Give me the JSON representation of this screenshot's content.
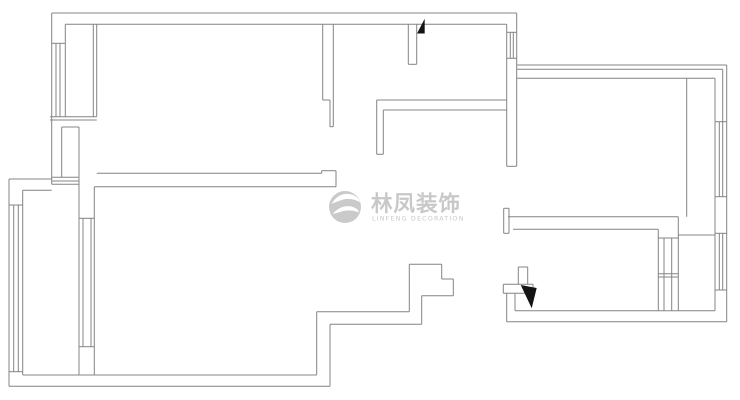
{
  "watermark": {
    "brand_cn": "林凤装饰",
    "brand_en": "LINFENG DECORATION",
    "color": "#c4c4c4",
    "logo_color": "#c6c6c6"
  },
  "floor_plan": {
    "background": "#ffffff",
    "stroke": "#848484",
    "marker_color": "#141414",
    "walls": [
      [
        52,
        13,
        516.7,
        13
      ],
      [
        516.7,
        13,
        516.7,
        166.3
      ],
      [
        516.7,
        65,
        726.7,
        65
      ],
      [
        726.7,
        65,
        726.7,
        321.7
      ],
      [
        506.7,
        321.7,
        726.7,
        321.7
      ],
      [
        506.7,
        293.3,
        506.7,
        321.7
      ],
      [
        503.3,
        284.3,
        533,
        284.3
      ],
      [
        503.3,
        293.3,
        533,
        293.3
      ],
      [
        503.3,
        284.3,
        503.3,
        293.3
      ],
      [
        533,
        284.3,
        533,
        293.3
      ],
      [
        518.3,
        267,
        518.3,
        284.3
      ],
      [
        527.7,
        267,
        527.7,
        284.3
      ],
      [
        518.3,
        267,
        527.7,
        267
      ],
      [
        515,
        293.3,
        515,
        310.7
      ],
      [
        409.3,
        264.3,
        441.7,
        264.3
      ],
      [
        441.7,
        264.3,
        441.7,
        279
      ],
      [
        441.7,
        279,
        453.3,
        279
      ],
      [
        453.3,
        279,
        453.3,
        295.7
      ],
      [
        421.7,
        295.7,
        453.3,
        295.7
      ],
      [
        421.7,
        295.7,
        421.7,
        324.3
      ],
      [
        330,
        324.3,
        421.7,
        324.3
      ],
      [
        330,
        324.3,
        330,
        386.3
      ],
      [
        9,
        386.3,
        330,
        386.3
      ],
      [
        22.7,
        375,
        316.7,
        375
      ],
      [
        409.3,
        264.3,
        409.3,
        311.7
      ],
      [
        316.7,
        311.7,
        409.3,
        311.7
      ],
      [
        316.7,
        311.7,
        316.7,
        375
      ],
      [
        9,
        179,
        9,
        386.3
      ],
      [
        9,
        179,
        51.7,
        179
      ],
      [
        22.7,
        190.3,
        51.7,
        190.3
      ],
      [
        22.7,
        190.3,
        22.7,
        375
      ],
      [
        51.7,
        13,
        51.7,
        184.3
      ],
      [
        65.3,
        24.3,
        65.3,
        43.3
      ],
      [
        65.3,
        24.3,
        506.7,
        24.3
      ],
      [
        93.3,
        24.3,
        93.3,
        116.7
      ],
      [
        96.7,
        24.3,
        96.7,
        116.7
      ],
      [
        50,
        116.7,
        96.7,
        116.7
      ],
      [
        50,
        120,
        96.7,
        120
      ],
      [
        61.7,
        127,
        61.7,
        177.3
      ],
      [
        79,
        127,
        79,
        177.3
      ],
      [
        61.7,
        127,
        79,
        127
      ],
      [
        51.7,
        177.3,
        79,
        177.3
      ],
      [
        51.7,
        181,
        79,
        181
      ],
      [
        51.7,
        184.3,
        79,
        184.3
      ],
      [
        79,
        177.3,
        79,
        375
      ],
      [
        94.3,
        186.7,
        94.3,
        375
      ],
      [
        96.7,
        173.3,
        321.7,
        173.3
      ],
      [
        94.3,
        186.7,
        336,
        186.7
      ],
      [
        321.7,
        170.7,
        321.7,
        173.3
      ],
      [
        321.7,
        170.7,
        336,
        170.7
      ],
      [
        336,
        170.7,
        336,
        186.7
      ],
      [
        322.7,
        24.3,
        322.7,
        100
      ],
      [
        322.7,
        100,
        330,
        100
      ],
      [
        330,
        100,
        330,
        126.7
      ],
      [
        330,
        126.7,
        333.3,
        126.7
      ],
      [
        333.3,
        24.3,
        333.3,
        126.7
      ],
      [
        408.3,
        24.3,
        408.3,
        64.3
      ],
      [
        416.7,
        24.3,
        416.7,
        64.3
      ],
      [
        408.3,
        64.3,
        416.7,
        64.3
      ],
      [
        376.7,
        100,
        506.7,
        100
      ],
      [
        383.3,
        110,
        506.7,
        110
      ],
      [
        376.7,
        100,
        376.7,
        154.3
      ],
      [
        383.3,
        110,
        383.3,
        154.3
      ],
      [
        376.7,
        154.3,
        383.3,
        154.3
      ],
      [
        506.7,
        24.3,
        506.7,
        166.3
      ],
      [
        506.7,
        166.3,
        516.7,
        166.3
      ],
      [
        516.7,
        69.3,
        722.7,
        69.3
      ],
      [
        722.7,
        69.3,
        722.7,
        121.7
      ],
      [
        516.7,
        78.3,
        715,
        78.3
      ],
      [
        686.7,
        78.3,
        686.7,
        216.7
      ],
      [
        715,
        78.3,
        715,
        121.7
      ],
      [
        715,
        196.7,
        715,
        233.3
      ],
      [
        715,
        290,
        715,
        310.7
      ],
      [
        508,
        216.7,
        678.3,
        216.7
      ],
      [
        513,
        229.3,
        658.3,
        229.3
      ],
      [
        503.7,
        208.3,
        509,
        208.3
      ],
      [
        503.7,
        233.3,
        509,
        233.3
      ],
      [
        503.7,
        208.3,
        503.7,
        233.3
      ],
      [
        509,
        208.3,
        509,
        233.3
      ],
      [
        678.3,
        216.7,
        678.3,
        235
      ],
      [
        678.3,
        235,
        715,
        235
      ],
      [
        658.3,
        229.3,
        658.3,
        310.7
      ],
      [
        678.3,
        235,
        678.3,
        310.7
      ],
      [
        515,
        310.7,
        715,
        310.7
      ]
    ],
    "window_lines": [
      [
        56,
        43.3,
        56,
        116.7
      ],
      [
        60,
        43.3,
        60,
        116.7
      ],
      [
        65.3,
        43.3,
        65.3,
        116.7
      ],
      [
        51.7,
        43.3,
        65.3,
        43.3
      ],
      [
        13.7,
        205,
        13.7,
        371.7
      ],
      [
        18.3,
        205,
        18.3,
        371.7
      ],
      [
        9,
        205,
        22.7,
        205
      ],
      [
        9,
        371.7,
        22.7,
        371.7
      ],
      [
        83,
        218.3,
        83,
        346.7
      ],
      [
        91,
        218.3,
        91,
        346.7
      ],
      [
        79,
        218.3,
        94.3,
        218.3
      ],
      [
        79,
        346.7,
        94.3,
        346.7
      ],
      [
        510.3,
        32.3,
        510.3,
        58.3
      ],
      [
        513.3,
        32.3,
        513.3,
        58.3
      ],
      [
        506.7,
        32.3,
        516.7,
        32.3
      ],
      [
        506.7,
        58.3,
        516.7,
        58.3
      ],
      [
        719.3,
        121.7,
        719.3,
        196.7
      ],
      [
        722.7,
        121.7,
        722.7,
        196.7
      ],
      [
        715,
        121.7,
        715,
        196.7
      ],
      [
        715,
        121.7,
        726.7,
        121.7
      ],
      [
        715,
        196.7,
        726.7,
        196.7
      ],
      [
        719.3,
        233.3,
        719.3,
        290
      ],
      [
        722.7,
        233.3,
        722.7,
        290
      ],
      [
        715,
        233.3,
        715,
        290
      ],
      [
        715,
        233.3,
        726.7,
        233.3
      ],
      [
        715,
        290,
        726.7,
        290
      ],
      [
        664,
        238,
        664,
        310.7
      ],
      [
        671.7,
        238,
        671.7,
        310.7
      ],
      [
        658.3,
        238,
        678.3,
        238
      ],
      [
        658.3,
        273.7,
        678.3,
        273.7
      ],
      [
        658.3,
        277,
        678.3,
        277
      ]
    ],
    "door_markers": [
      [
        [
          417,
          33.5
        ],
        [
          424.7,
          18.7
        ],
        [
          424.7,
          33.5
        ]
      ],
      [
        [
          520.7,
          285
        ],
        [
          536.7,
          288
        ],
        [
          531.7,
          308.3
        ]
      ]
    ]
  }
}
